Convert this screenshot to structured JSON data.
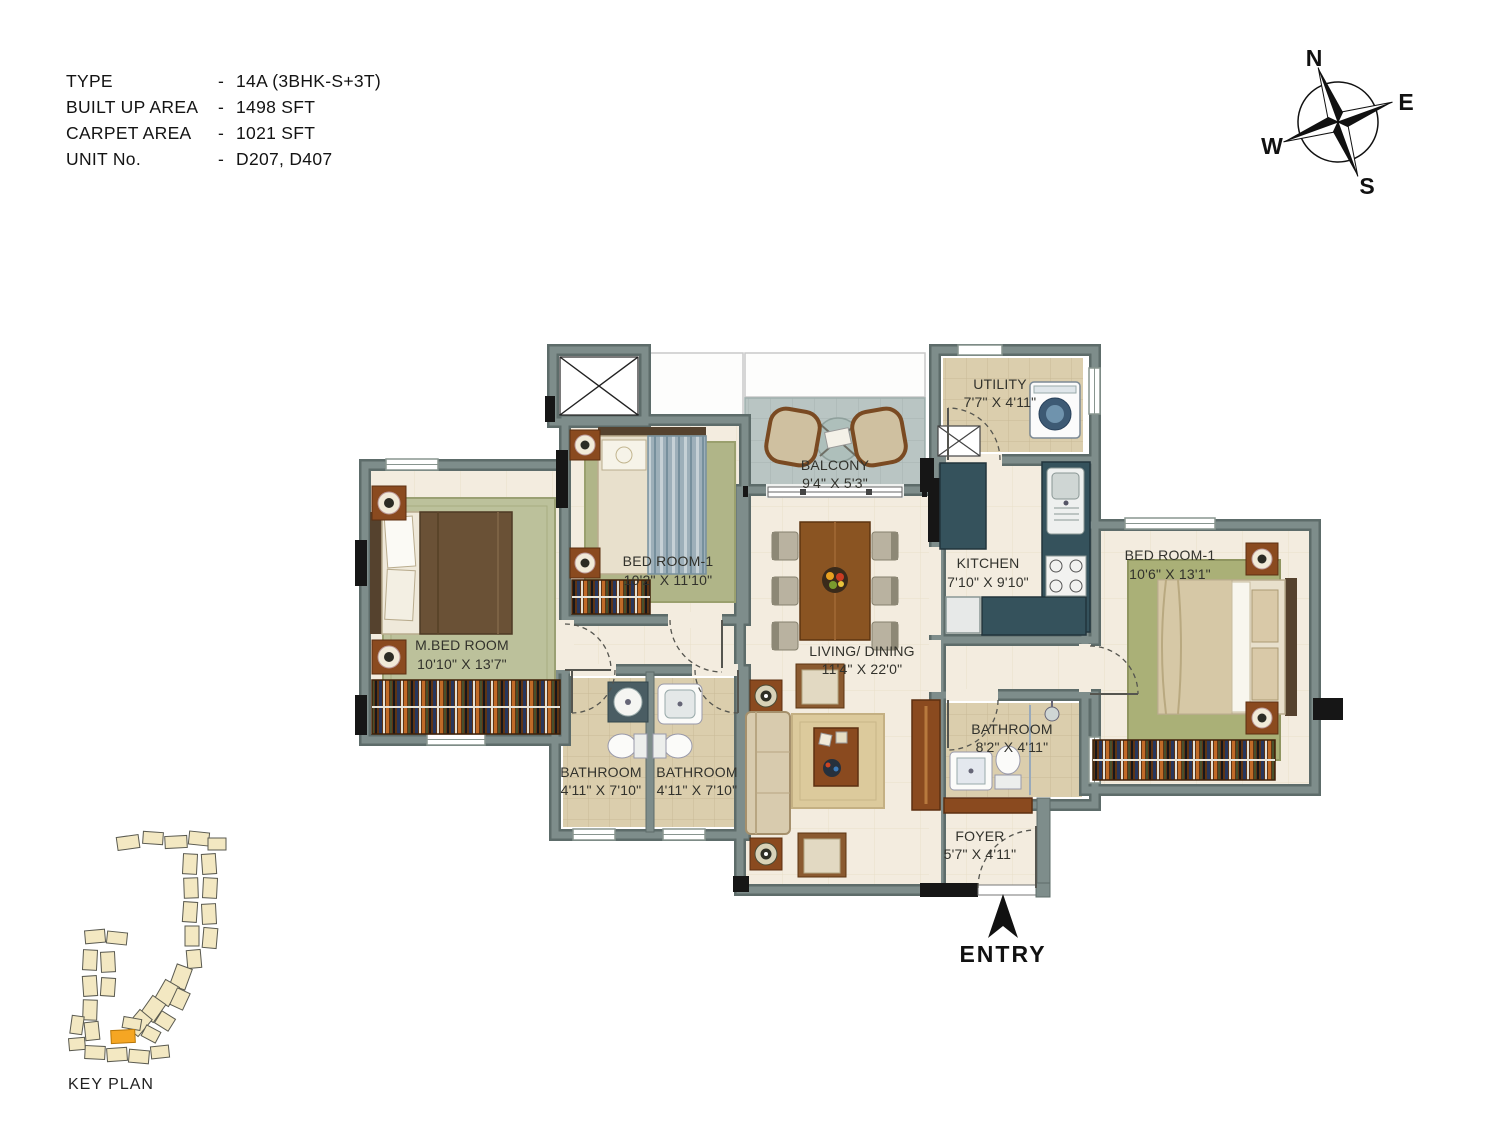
{
  "header": {
    "separator": "-",
    "rows": [
      {
        "label": "TYPE",
        "value": "14A (3BHK-S+3T)"
      },
      {
        "label": "BUILT UP AREA",
        "value": "1498 SFT"
      },
      {
        "label": "CARPET AREA",
        "value": "1021 SFT"
      },
      {
        "label": "UNIT No.",
        "value": "D207, D407"
      }
    ]
  },
  "compass": {
    "north": "N",
    "east": "E",
    "south": "S",
    "west": "W"
  },
  "rooms": [
    {
      "name": "M.BED ROOM",
      "dims": "10'10\" X 13'7\""
    },
    {
      "name": "BED ROOM-1",
      "dims": "10'2\" X 11'10\""
    },
    {
      "name": "BALCONY",
      "dims": "9'4\" X 5'3\""
    },
    {
      "name": "UTILITY",
      "dims": "7'7\" X 4'11\""
    },
    {
      "name": "KITCHEN",
      "dims": "7'10\" X 9'10\""
    },
    {
      "name": "LIVING/ DINING",
      "dims": "11'4\" X 22'0\""
    },
    {
      "name": "BATHROOM",
      "dims": "4'11\" X 7'10\""
    },
    {
      "name": "BATHROOM",
      "dims": "4'11\" X 7'10\""
    },
    {
      "name": "BATHROOM",
      "dims": "8'2\" X 4'11\""
    },
    {
      "name": "BED ROOM-1",
      "dims": "10'6\" X 13'1\""
    },
    {
      "name": "FOYER",
      "dims": "5'7\" X 4'11\""
    }
  ],
  "entry": {
    "label": "ENTRY"
  },
  "key_plan": {
    "label": "KEY PLAN",
    "highlight_color": "#f5a623"
  },
  "colors": {
    "wall": "#7e8d8b",
    "wall_outline": "#5d6c6a",
    "floor": "#f3ecdf",
    "wet_tile": "#dbcead",
    "balcony_tile": "#b9c5c3",
    "counter": "#35525c",
    "wood": "#8a4a1f",
    "wardrobe": "#5e3414",
    "text": "#32322c"
  }
}
